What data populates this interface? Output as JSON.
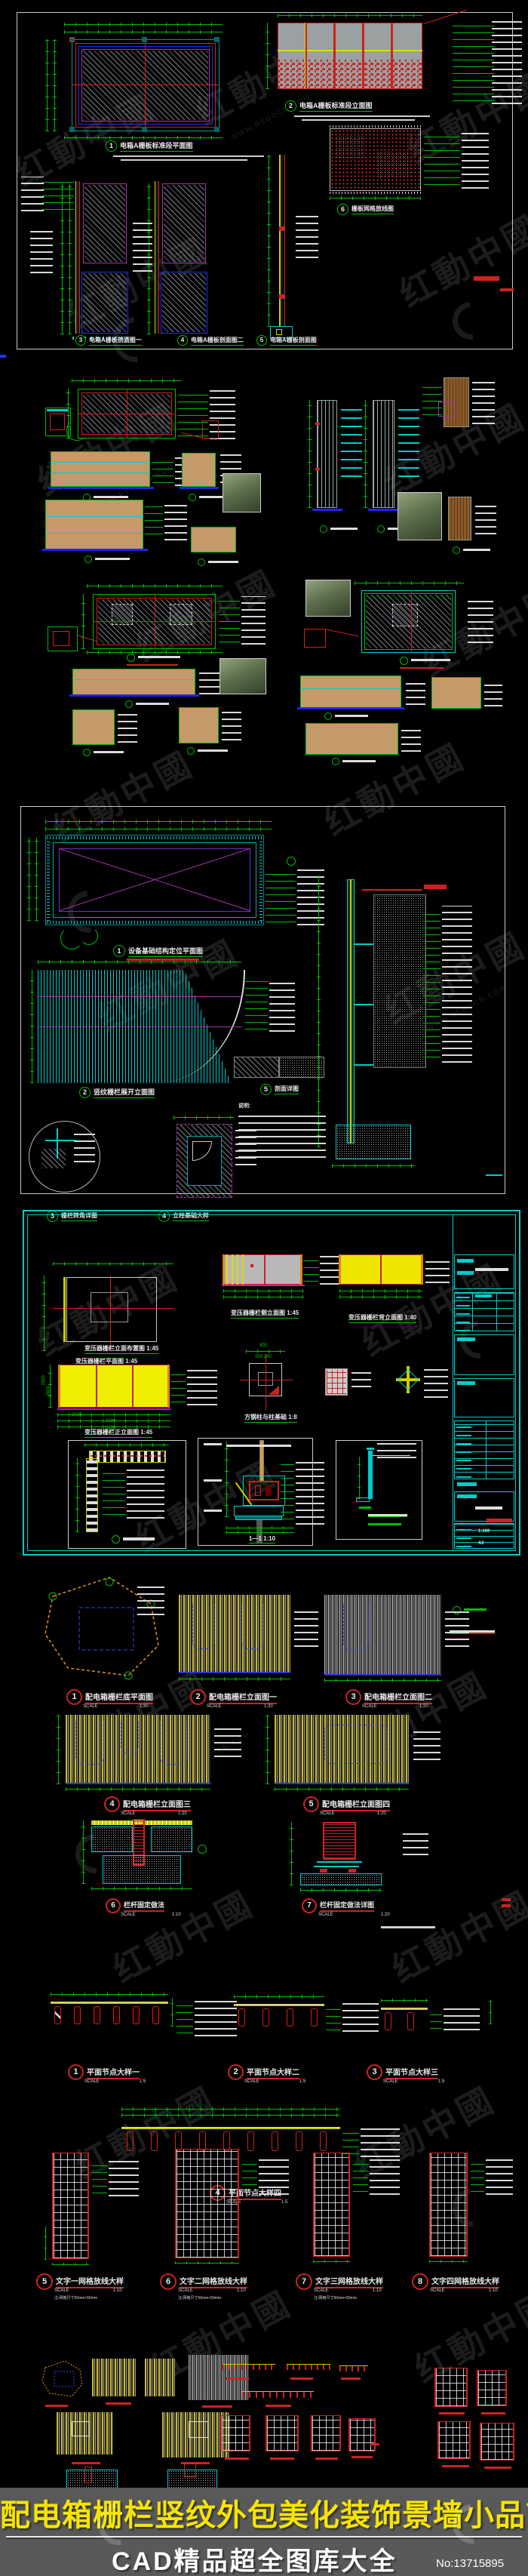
{
  "watermark": {
    "brand": "红動中國",
    "site": "WWW.REDOCN.COM"
  },
  "banner": {
    "title": "配电箱栅栏竖纹外包美化装饰景墙小品节点",
    "subtitle": "CAD精品超全图库大全",
    "number": "No:13715895"
  },
  "sheet1": {
    "details": [
      {
        "num": "1",
        "title": "电箱A栅板标准段平面图"
      },
      {
        "num": "2",
        "title": "电箱A栅板标准段立面图"
      },
      {
        "num": "3",
        "title": "电箱A栅板剖面图一"
      },
      {
        "num": "4",
        "title": "电箱A栅板剖面图二"
      },
      {
        "num": "5",
        "title": "电箱A栅板剖面图"
      },
      {
        "num": "6",
        "title": "栅板网格放线图"
      }
    ]
  },
  "sheet3": {
    "note_head": "说明:",
    "details": [
      {
        "num": "1",
        "title": "设备基础结构定位平面图"
      },
      {
        "num": "2",
        "title": "竖纹栅栏展开立面图"
      },
      {
        "num": "3",
        "title": "栅栏转角详图"
      },
      {
        "num": "4",
        "title": "立柱基础大样"
      },
      {
        "num": "5",
        "title": "剖面详图"
      }
    ]
  },
  "sheet4": {
    "titles": {
      "plan": "变压器栅栏平面图 1:45",
      "side": "变压器栅栏侧立面图 1:45",
      "back": "变压器栅栏背立面图 1:40",
      "front_top": "变压器栅栏立面布置图 1:45",
      "front": "变压器栅栏正立面图 1:45",
      "foundation": "方钢柱与柱基础 1:8",
      "section": "1—1 1:10"
    },
    "dims": [
      "2020",
      "1030",
      "6180",
      "2500",
      "2400",
      "900",
      "200 200"
    ],
    "titleblock": {
      "scale": "1:100",
      "size": "A2"
    }
  },
  "cluster5": {
    "scale_label": "SCALE",
    "details": [
      {
        "num": "1",
        "title": "配电箱栅栏底平面图",
        "scale": "1:30"
      },
      {
        "num": "2",
        "title": "配电箱栅栏立面图一",
        "scale": "1:20"
      },
      {
        "num": "3",
        "title": "配电箱栅栏立面图二",
        "scale": "1:20"
      },
      {
        "num": "4",
        "title": "配电箱栅栏立面图三",
        "scale": "1:20"
      },
      {
        "num": "5",
        "title": "配电箱栅栏立面图四",
        "scale": "1:20"
      },
      {
        "num": "6",
        "title": "栏杆固定做法",
        "scale": "1:10"
      },
      {
        "num": "7",
        "title": "栏杆固定做法详图",
        "scale": "1:20"
      }
    ]
  },
  "cluster7": {
    "scale_label": "SCALE",
    "details": [
      {
        "num": "1",
        "title": "平面节点大样一",
        "scale": "1:5"
      },
      {
        "num": "2",
        "title": "平面节点大样二",
        "scale": "1:5"
      },
      {
        "num": "3",
        "title": "平面节点大样三",
        "scale": "1:5"
      },
      {
        "num": "4",
        "title": "平面节点大样四",
        "scale": "1:5"
      }
    ]
  },
  "cluster8": {
    "scale_label": "SCALE",
    "note": "注:网格尺寸50mm×50mm",
    "details": [
      {
        "num": "5",
        "title": "文字一网格放线大样",
        "scale": "1:10"
      },
      {
        "num": "6",
        "title": "文字二网格放线大样",
        "scale": "1:10"
      },
      {
        "num": "7",
        "title": "文字三网格放线大样",
        "scale": "1:10"
      },
      {
        "num": "8",
        "title": "文字四网格放线大样",
        "scale": "1:10"
      }
    ]
  }
}
